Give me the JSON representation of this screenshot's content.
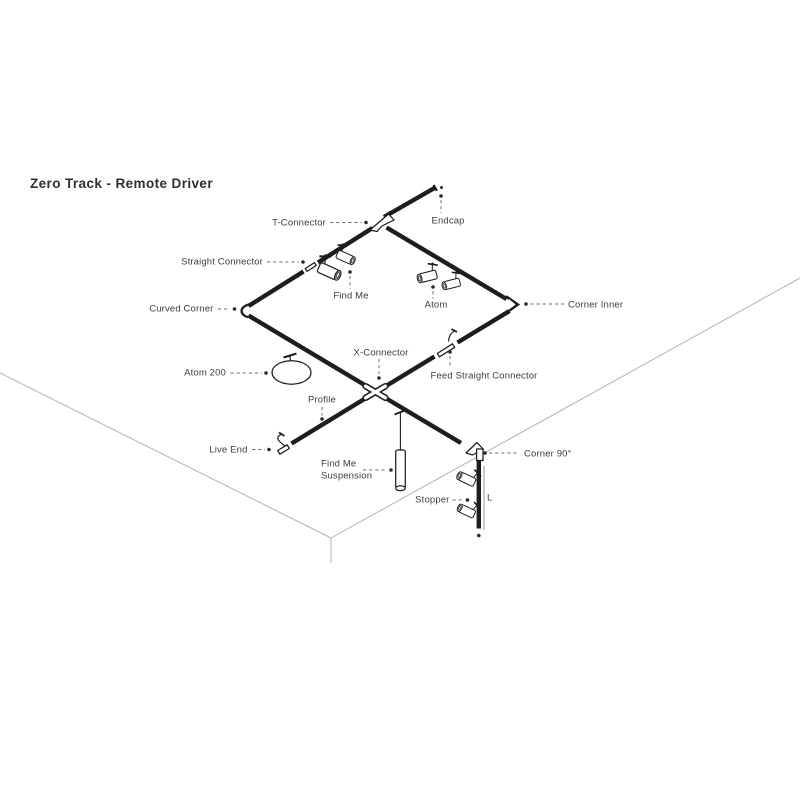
{
  "title": "Zero Track - Remote Driver",
  "diagram": {
    "labels": {
      "t_connector": "T-Connector",
      "endcap": "Endcap",
      "straight_connector": "Straight Connector",
      "find_me": "Find Me",
      "atom": "Atom",
      "corner_inner": "Corner Inner",
      "curved_corner": "Curved Corner",
      "atom_200": "Atom 200",
      "x_connector": "X-Connector",
      "feed_straight_connector": "Feed Straight Connector",
      "profile": "Profile",
      "live_end": "Live End",
      "find_me_suspension": {
        "line1": "Find Me",
        "line2": "Suspension"
      },
      "corner_90": "Corner 90°",
      "stopper": "Stopper",
      "length_marker": "L"
    },
    "colors": {
      "background": "#ffffff",
      "track": "#1d1d1d",
      "label_text": "#3d3d3d",
      "leader_line": "#6e6e6e",
      "room_edge": "#b3b3b3"
    }
  }
}
